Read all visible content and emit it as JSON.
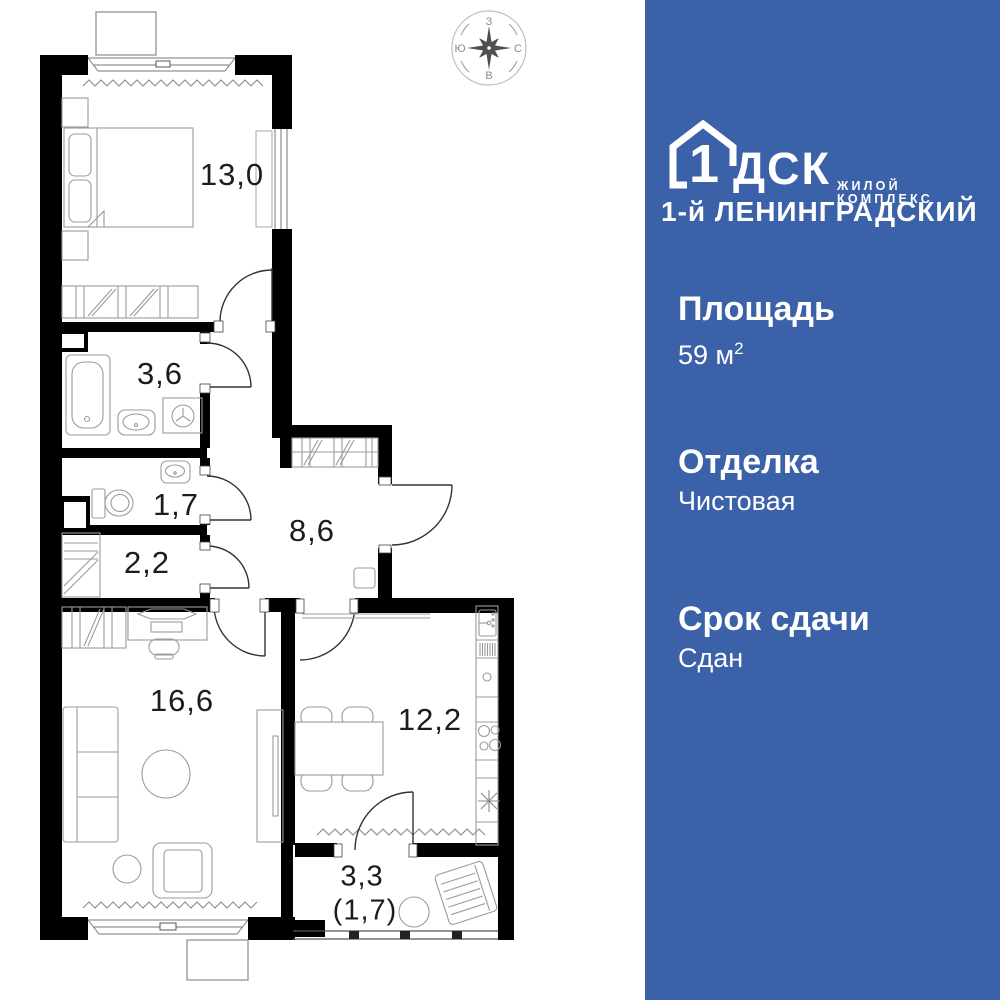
{
  "plan": {
    "rooms": [
      {
        "name": "bedroom",
        "area": "13,0"
      },
      {
        "name": "bathroom",
        "area": "3,6"
      },
      {
        "name": "wc",
        "area": "1,7"
      },
      {
        "name": "closet",
        "area": "2,2"
      },
      {
        "name": "hallway",
        "area": "8,6"
      },
      {
        "name": "living-room",
        "area": "16,6"
      },
      {
        "name": "kitchen",
        "area": "12,2"
      },
      {
        "name": "balcony",
        "area": "3,3",
        "area_secondary": "(1,7)"
      }
    ],
    "compass": {
      "top": "З",
      "right": "С",
      "bottom": "В",
      "left": "Ю"
    }
  },
  "panel": {
    "logo": {
      "number": "1",
      "brand": "ДСК",
      "tagline": "ЖИЛОЙ КОМПЛЕКС",
      "complex_name": "1-й ЛЕНИНГРАДСКИЙ"
    },
    "specs": [
      {
        "label": "Площадь",
        "value": "59 м",
        "sup": "2"
      },
      {
        "label": "Отделка",
        "value": "Чистовая"
      },
      {
        "label": "Срок сдачи",
        "value": "Сдан"
      }
    ]
  },
  "colors": {
    "panel_blue": "#3b61a8",
    "wall_black": "#000000",
    "furniture_gray": "#9b9b9b",
    "label_dark": "#1c1c1c"
  }
}
